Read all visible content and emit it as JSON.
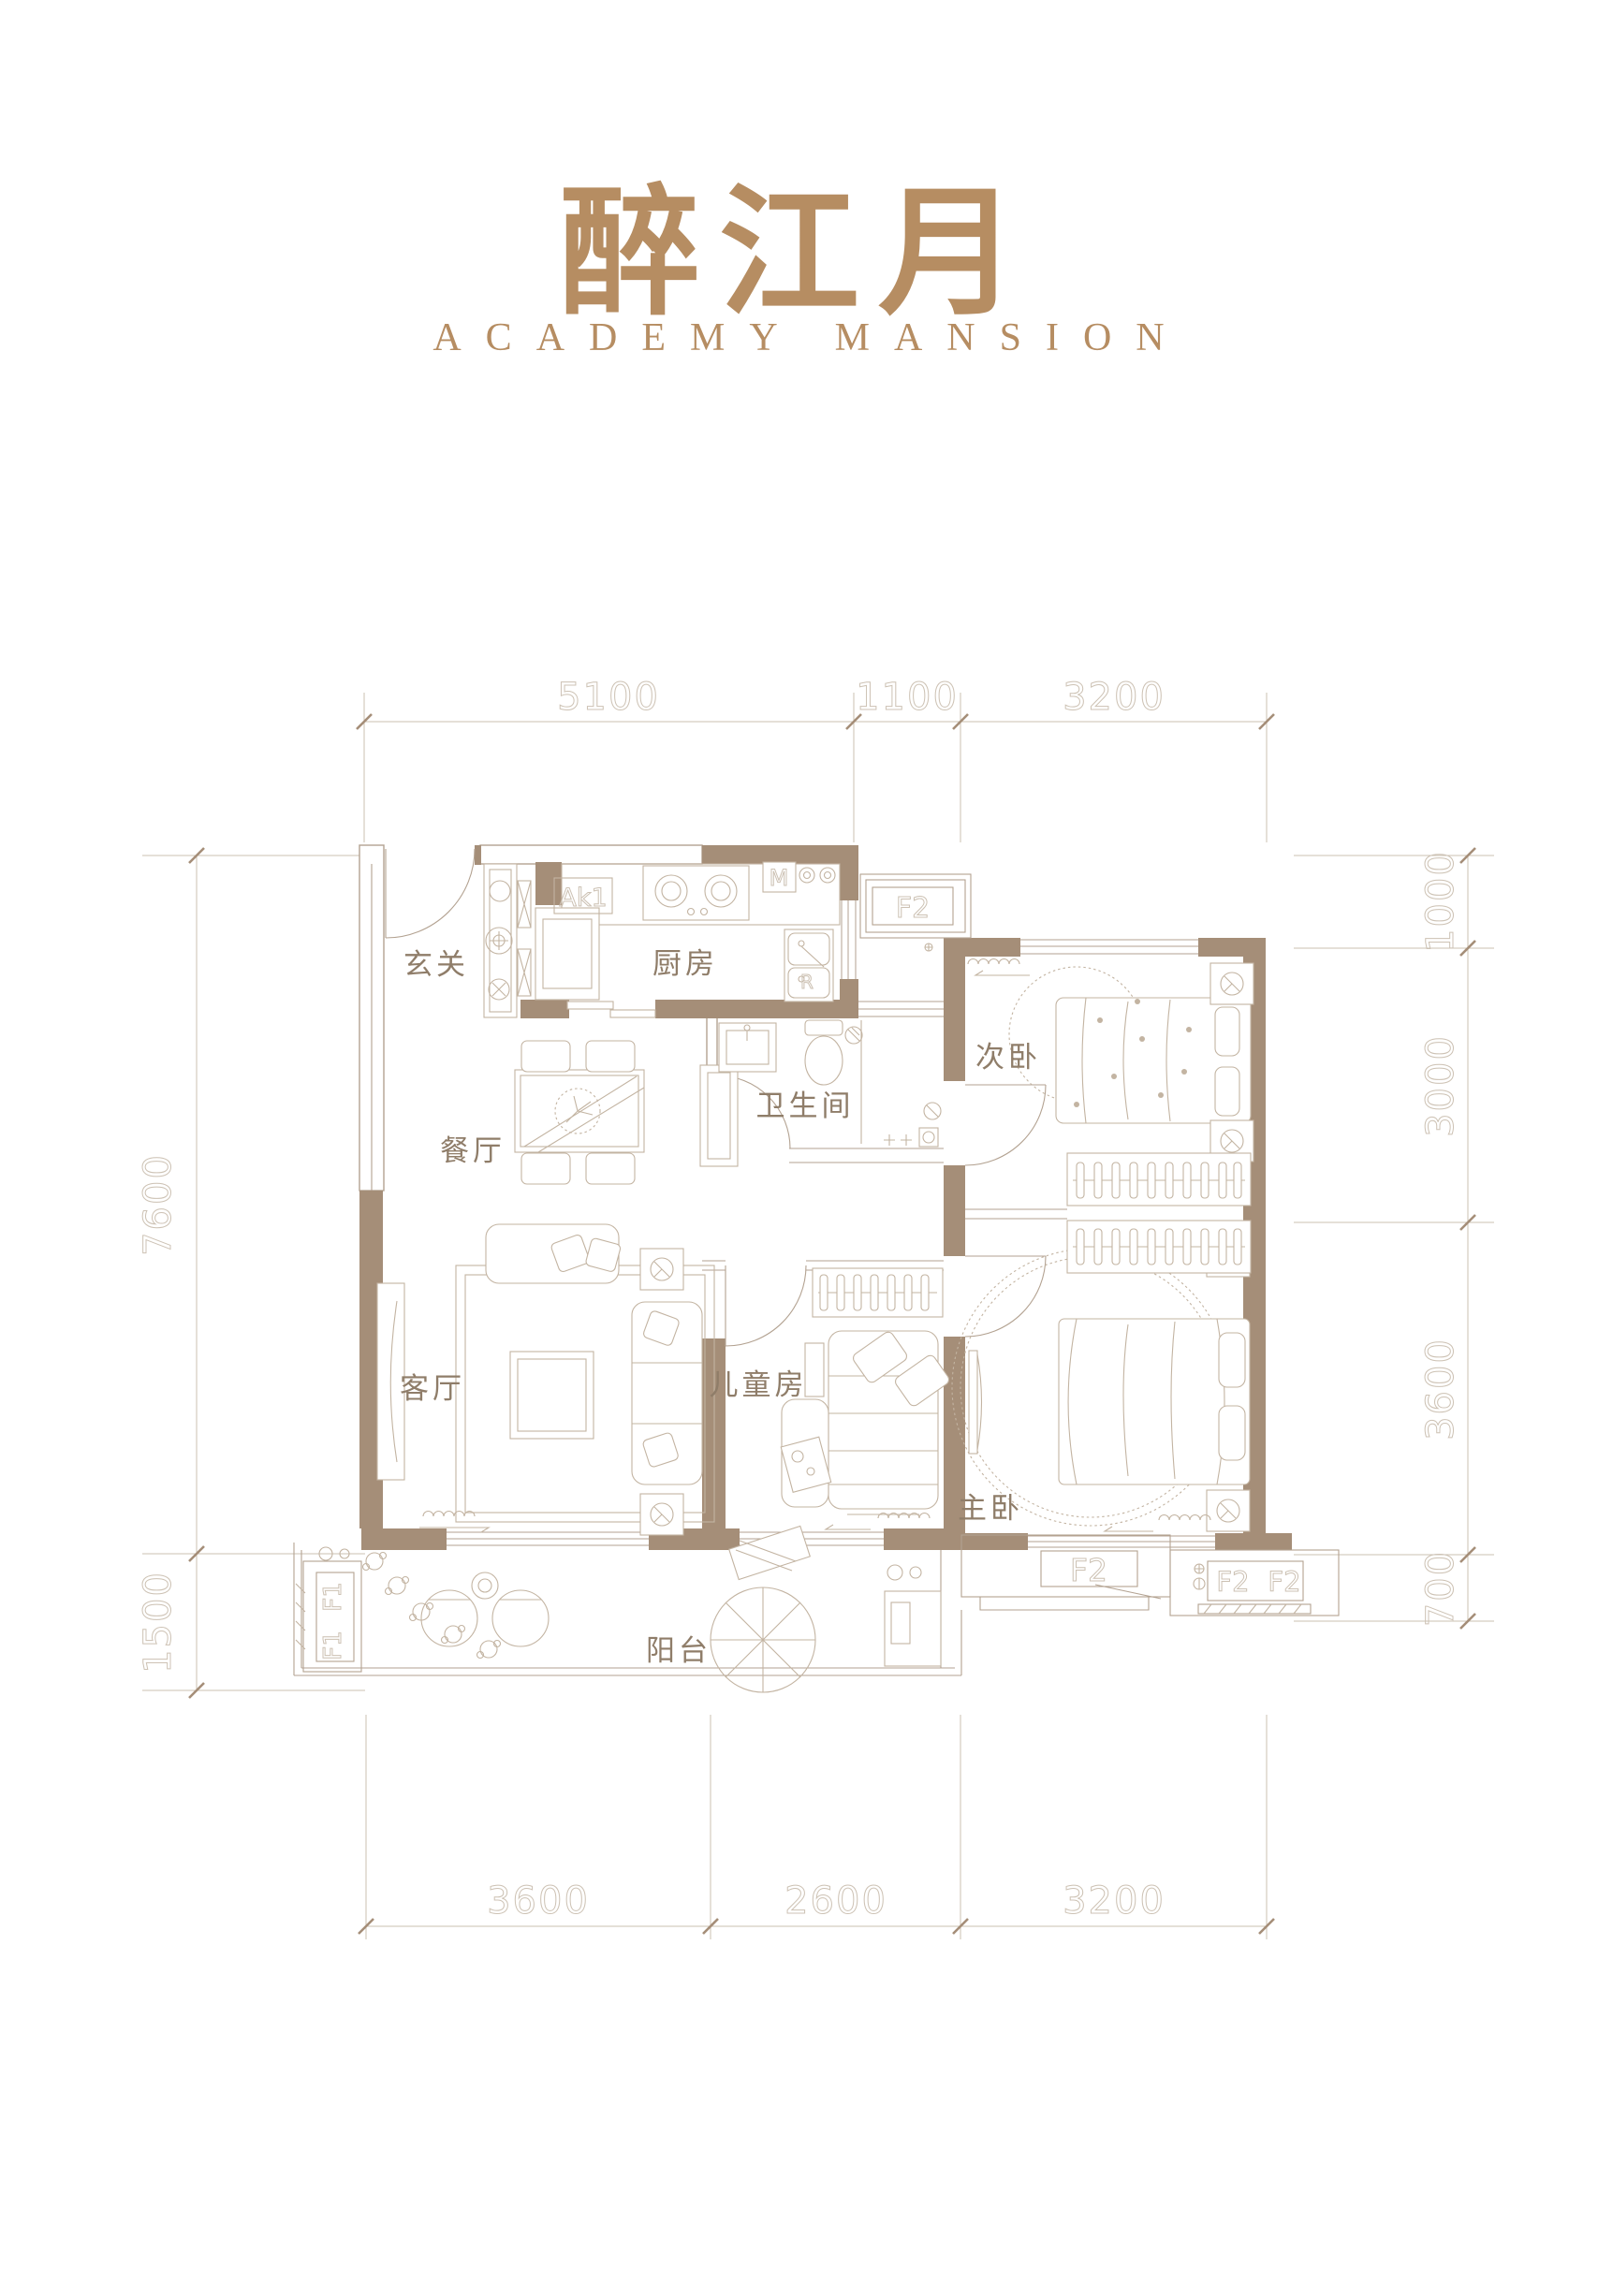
{
  "brand": {
    "title": "醉江月",
    "subtitle": "ACADEMY MANSION"
  },
  "colors": {
    "brand_gold": "#b68d62",
    "wall_fill": "#a58e78",
    "plan_line": "#b3a291",
    "furniture_line": "#c3b4a2",
    "dim_text": "#cdc2b4",
    "room_text": "#8f7d69",
    "background": "#ffffff"
  },
  "dimensions": {
    "top": [
      "5100",
      "1100",
      "3200"
    ],
    "bottom": [
      "3600",
      "2600",
      "3200"
    ],
    "left": [
      "7600",
      "1500"
    ],
    "right": [
      "1000",
      "3000",
      "3600",
      "700"
    ]
  },
  "rooms": {
    "entry": "玄关",
    "kitchen": "厨房",
    "dining": "餐厅",
    "bathroom": "卫生间",
    "bedroom2": "次卧",
    "living": "客厅",
    "kids": "儿童房",
    "master": "主卧",
    "balcony": "阳台"
  },
  "marks": {
    "ak": "Ak1",
    "m": "M",
    "r": "R",
    "f2": "F2",
    "f1": "F1"
  }
}
